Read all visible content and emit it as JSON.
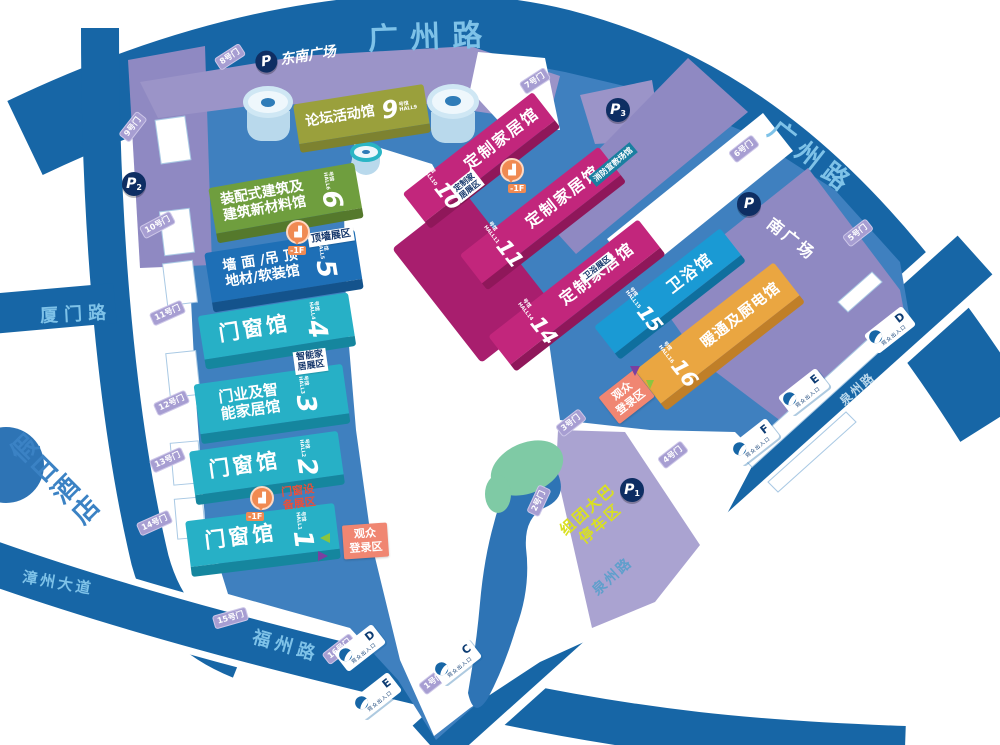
{
  "roads": {
    "guangzhou_top": "广州路",
    "guangzhou_right": "广州路",
    "xiamen": "厦门路",
    "zhangzhou": "漳州大道",
    "fuzhou": "福州路",
    "quanzhou_a": "泉州路",
    "quanzhou_b": "泉州路"
  },
  "places": {
    "hotel": "假日酒店",
    "se_plaza": "东南广场",
    "south_plaza": "南广场",
    "fire_hall": "消防宣教场馆",
    "bus_l1": "组团大巴",
    "bus_l2": "停车区"
  },
  "parking": {
    "p": "P",
    "sub1": "1",
    "sub2": "2",
    "sub3": "3"
  },
  "halls": [
    {
      "num": "9",
      "unit": "号馆",
      "en": "HALL9",
      "n1": "论坛活动馆",
      "n2": ""
    },
    {
      "num": "6",
      "unit": "号馆",
      "en": "HALL6",
      "n1": "装配式建筑及",
      "n2": "建筑新材料馆"
    },
    {
      "num": "5",
      "unit": "号馆",
      "en": "HALL5",
      "n1": "墙 面 /吊 顶",
      "n2": "地材/软装馆"
    },
    {
      "num": "4",
      "unit": "号馆",
      "en": "HALL4",
      "n1": "门窗馆",
      "n2": ""
    },
    {
      "num": "3",
      "unit": "号馆",
      "en": "HALL3",
      "n1": "门业及智",
      "n2": "能家居馆"
    },
    {
      "num": "2",
      "unit": "号馆",
      "en": "HALL2",
      "n1": "门窗馆",
      "n2": ""
    },
    {
      "num": "1",
      "unit": "号馆",
      "en": "HALL1",
      "n1": "门窗馆",
      "n2": ""
    },
    {
      "num": "10",
      "unit": "号馆",
      "en": "HALL10",
      "n1": "定制家居馆",
      "n2": ""
    },
    {
      "num": "11",
      "unit": "号馆",
      "en": "HALL11",
      "n1": "定制家居馆",
      "n2": ""
    },
    {
      "num": "14",
      "unit": "号馆",
      "en": "HALL14",
      "n1": "定制家居馆",
      "n2": ""
    },
    {
      "num": "15",
      "unit": "号馆",
      "en": "HALL15",
      "n1": "卫浴馆",
      "n2": ""
    },
    {
      "num": "16",
      "unit": "号馆",
      "en": "HALL16",
      "n1": "暖通及厨电馆",
      "n2": ""
    }
  ],
  "zones": {
    "ceiling": "顶墙展区",
    "smart1": "智能家",
    "smart2": "居展区",
    "custom1": "定制家",
    "custom2": "居展区",
    "bath": "卫浴展区",
    "doorq1": "门窗设",
    "doorq2": "备展区"
  },
  "registration": {
    "l1": "观众",
    "l2": "登录区"
  },
  "floors": {
    "f6": "-1F",
    "f10": "-1F",
    "f1": "-1F"
  },
  "gates": {
    "g1": "1号门",
    "g2": "2号门",
    "g3": "3号门",
    "g4": "4号门",
    "g5": "5号门",
    "g6": "6号门",
    "g7": "7号门",
    "g8": "8号门",
    "g9": "9号门",
    "g10": "10号门",
    "g11": "11号门",
    "g12": "12号门",
    "g13": "13号门",
    "g14": "14号门",
    "g15": "15号门",
    "g16": "16号门"
  },
  "entrances": {
    "label": "观众出入口",
    "c": "C",
    "d": "D",
    "e": "E",
    "f": "F"
  }
}
